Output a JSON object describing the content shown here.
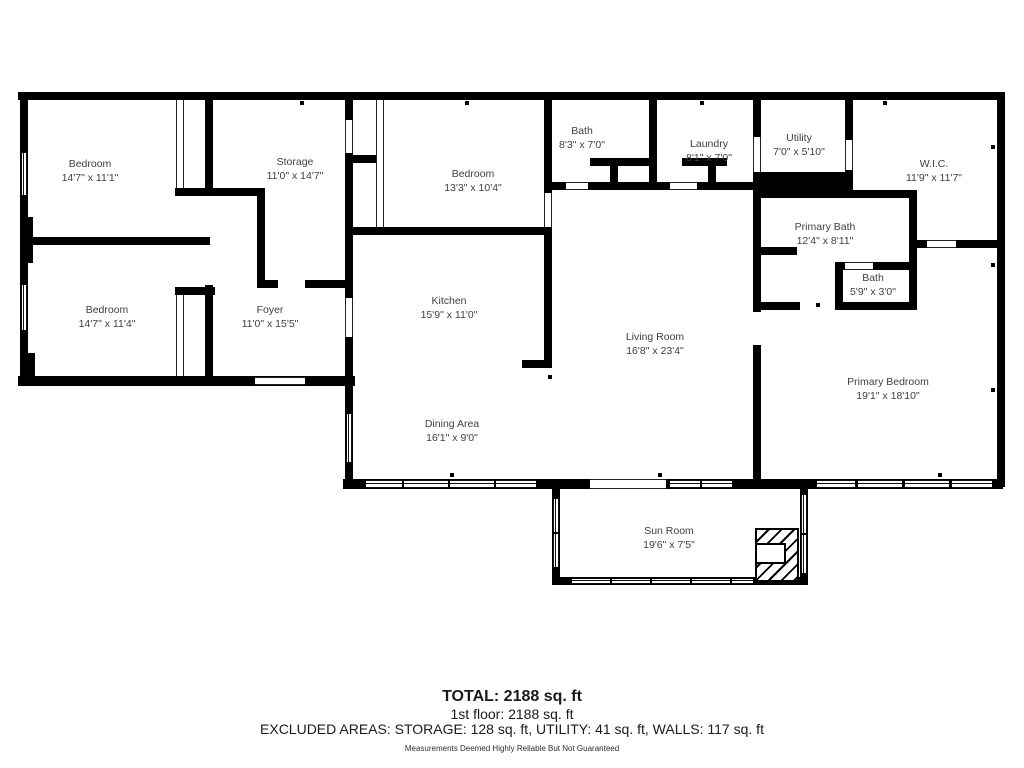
{
  "rooms": {
    "bedroom1": {
      "name": "Bedroom",
      "dims": "14'7\" x 11'1\""
    },
    "storage": {
      "name": "Storage",
      "dims": "11'0\" x 14'7\""
    },
    "bedroom2": {
      "name": "Bedroom",
      "dims": "13'3\" x 10'4\""
    },
    "bath1": {
      "name": "Bath",
      "dims": "8'3\" x 7'0\""
    },
    "laundry": {
      "name": "Laundry",
      "dims": "8'1\" x 7'0\""
    },
    "utility": {
      "name": "Utility",
      "dims": "7'0\" x 5'10\""
    },
    "wic": {
      "name": "W.I.C.",
      "dims": "11'9\" x 11'7\""
    },
    "primary_bath": {
      "name": "Primary Bath",
      "dims": "12'4\" x 8'11\""
    },
    "bath2": {
      "name": "Bath",
      "dims": "5'9\" x 3'0\""
    },
    "bedroom3": {
      "name": "Bedroom",
      "dims": "14'7\" x 11'4\""
    },
    "foyer": {
      "name": "Foyer",
      "dims": "11'0\" x 15'5\""
    },
    "kitchen": {
      "name": "Kitchen",
      "dims": "15'9\" x 11'0\""
    },
    "living": {
      "name": "Living Room",
      "dims": "16'8\" x 23'4\""
    },
    "dining": {
      "name": "Dining Area",
      "dims": "16'1\" x 9'0\""
    },
    "primary_bedroom": {
      "name": "Primary Bedroom",
      "dims": "19'1\" x 18'10\""
    },
    "sunroom": {
      "name": "Sun Room",
      "dims": "19'6\" x 7'5\""
    }
  },
  "footer": {
    "total": "TOTAL: 2188 sq. ft",
    "floor": "1st floor: 2188 sq. ft",
    "excluded": "EXCLUDED AREAS: STORAGE: 128 sq. ft, UTILITY: 41 sq. ft, WALLS: 117 sq. ft",
    "disclaimer": "Measurements Deemed Highly Reliable But Not Guaranteed"
  },
  "colors": {
    "wall": "#000000",
    "text": "#3f3f3f",
    "background": "#ffffff"
  }
}
